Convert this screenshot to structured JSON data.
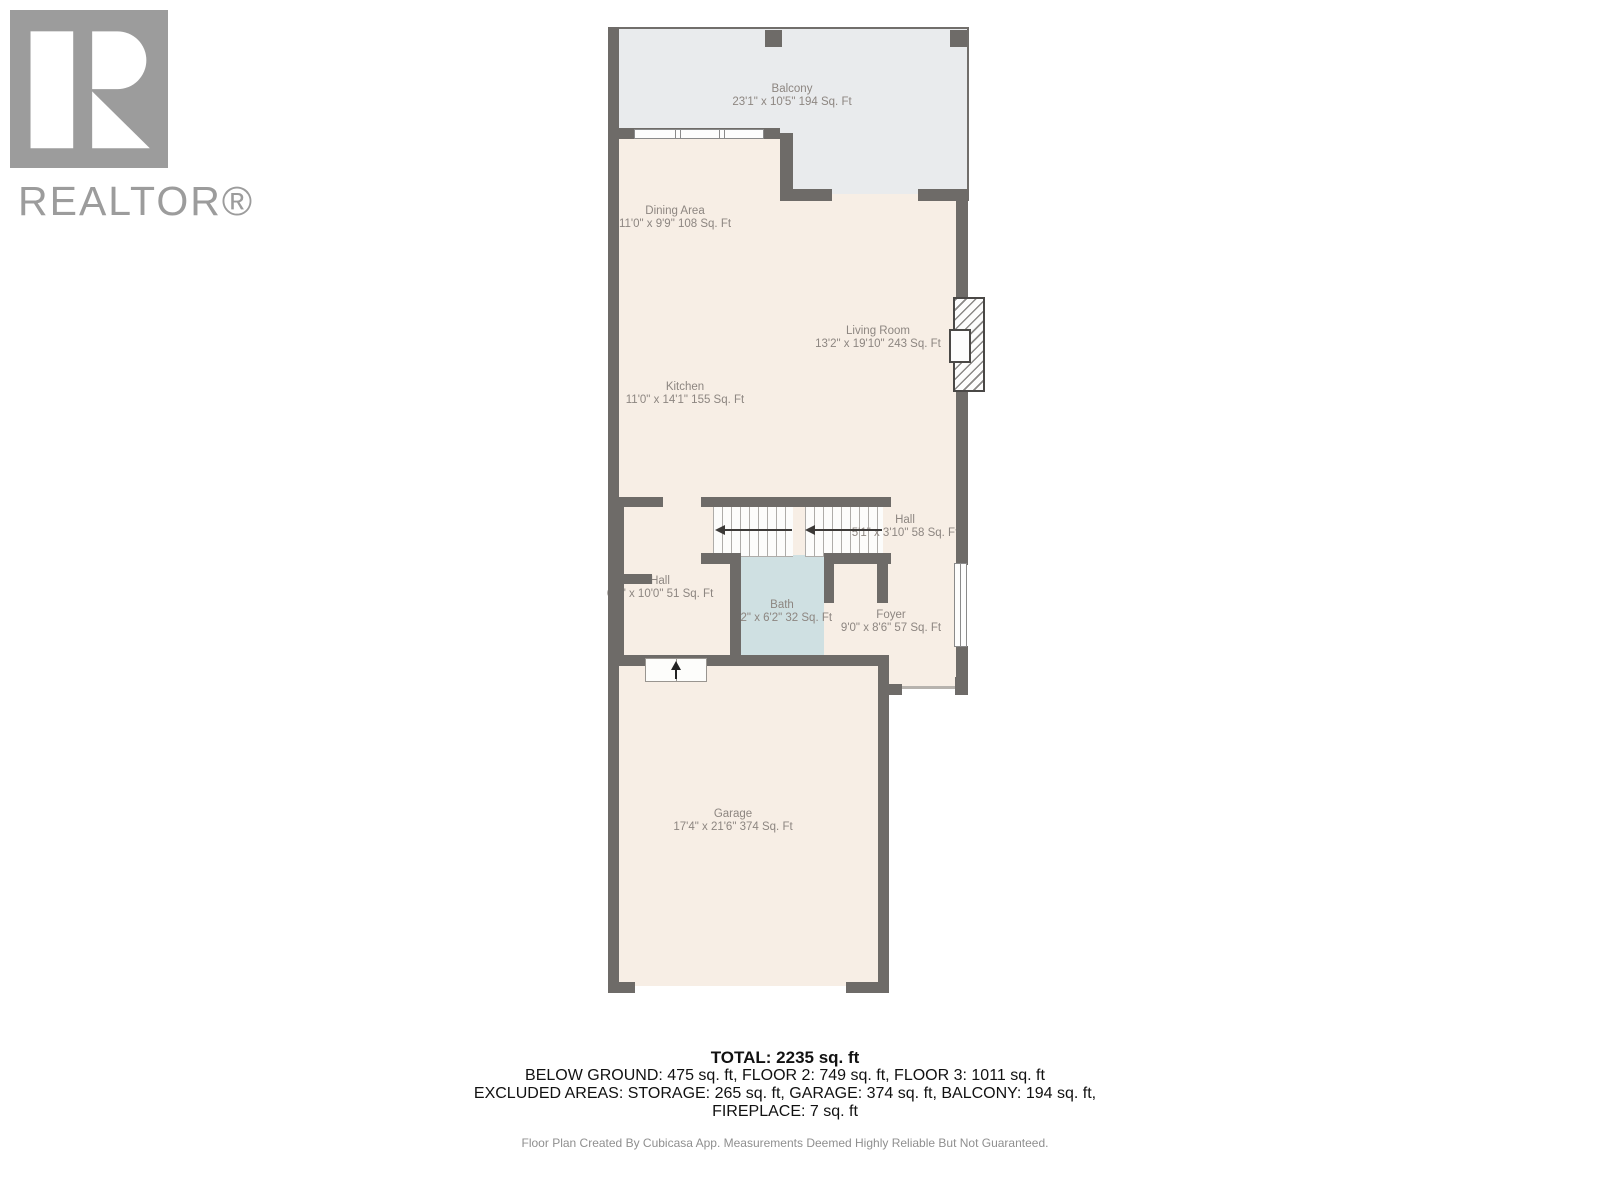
{
  "branding": {
    "name": "REALTOR®",
    "logo_letter": "R"
  },
  "rooms": [
    {
      "name": "Balcony",
      "dims": "23'1\" x 10'5\" 194 Sq. Ft"
    },
    {
      "name": "Dining Area",
      "dims": "11'0\" x 9'9\" 108 Sq. Ft"
    },
    {
      "name": "Living Room",
      "dims": "13'2\" x 19'10\" 243 Sq. Ft"
    },
    {
      "name": "Kitchen",
      "dims": "11'0\" x 14'1\" 155 Sq. Ft"
    },
    {
      "name": "Hall",
      "dims": "5'1\" x 3'10\" 58 Sq. Ft"
    },
    {
      "name": "Hall",
      "dims": "6'4\" x 10'0\" 51 Sq. Ft"
    },
    {
      "name": "Bath",
      "dims": "5'2\" x 6'2\" 32 Sq. Ft"
    },
    {
      "name": "Foyer",
      "dims": "9'0\" x 8'6\" 57 Sq. Ft"
    },
    {
      "name": "Garage",
      "dims": "17'4\" x 21'6\" 374 Sq. Ft"
    }
  ],
  "summary": {
    "total": "TOTAL: 2235 sq. ft",
    "line_floors": "BELOW GROUND: 475 sq. ft, FLOOR 2: 749 sq. ft, FLOOR 3: 1011 sq. ft",
    "line_excluded": "EXCLUDED AREAS: STORAGE: 265 sq. ft, GARAGE: 374 sq. ft, BALCONY: 194 sq. ft,",
    "line_fireplace": "FIREPLACE: 7 sq. ft"
  },
  "disclaimer": "Floor Plan Created By Cubicasa App. Measurements Deemed Highly Reliable But Not Guaranteed.",
  "colors": {
    "wall": "#6e6b68",
    "floor": "#f7eee5",
    "balcony": "#e9ebed",
    "bath": "#cfe0e2",
    "label": "#8d8681",
    "logo": "#9c9c9c"
  }
}
